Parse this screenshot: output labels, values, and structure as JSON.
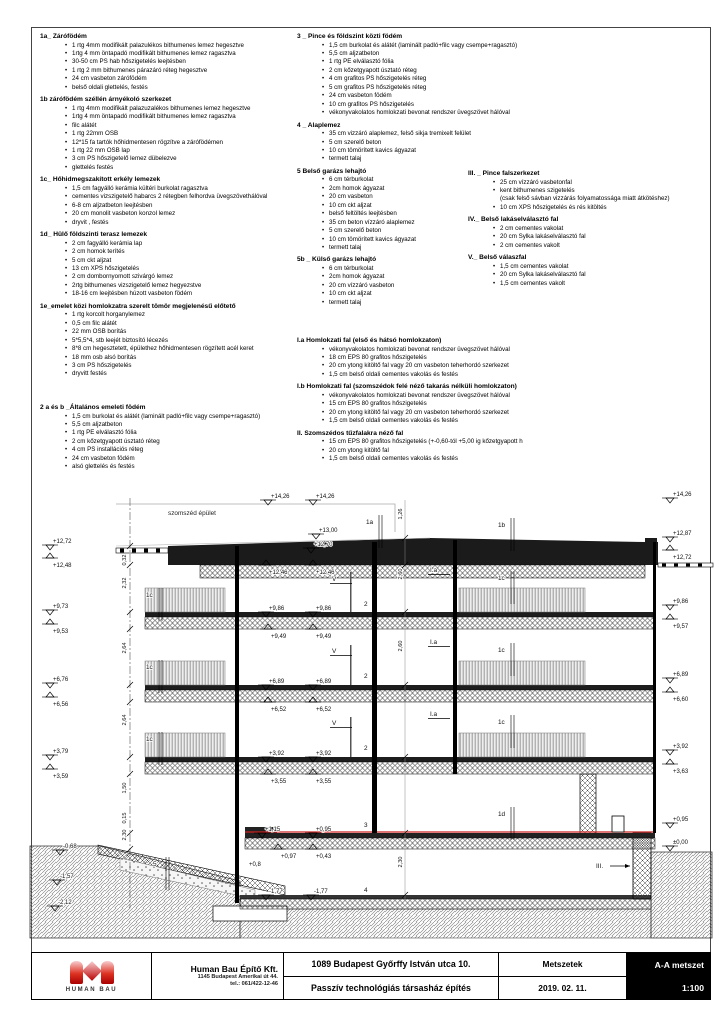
{
  "drawing_meta": {
    "neighbor_label": "szomszéd épület",
    "waterproof_color": "#cc2222"
  },
  "specs": {
    "col1a": [
      {
        "h": "1a_ Zárófödém",
        "items": [
          [
            "•",
            "1 rtg 4mm modifikált palazulékos bithumenes lemez hegesztve"
          ],
          [
            "•",
            "1rtg 4 mm öntapadó modifikált bithumenes lemez ragasztva"
          ],
          [
            "•",
            "30-50 cm PS hab hőszigetelés leejtésben"
          ],
          [
            "•",
            "1 rtg 2 mm bithumenes párazáró réteg hegesztve"
          ],
          [
            "•",
            "24 cm vasbeton zárófödém"
          ],
          [
            "•",
            "belső oldali glettelés, festés"
          ]
        ]
      },
      {
        "h": "1b zárófödém széllén árnyékoló szerkezet",
        "items": [
          [
            "•",
            "1 rtg 4mm modifikált palazuzalékos bithumenes lemez hegesztve"
          ],
          [
            "•",
            "1rtg 4 mm öntapadó modifikált bithumenes lemez ragasztva"
          ],
          [
            "•",
            "filc alátét"
          ],
          [
            "•",
            "1 rtg 22mm OSB"
          ],
          [
            "•",
            "12*15 fa tartók hőhidmentesen rögzítve a zárófödémen"
          ],
          [
            "•",
            "1 rtg 22 mm OSB lap"
          ],
          [
            "•",
            "3 cm PS hőszigetelő lemez dübelezve"
          ],
          [
            "•",
            "glettelés festés"
          ]
        ]
      },
      {
        "h": "1c_ Hőhidmegszakított erkély lemezek",
        "items": [
          [
            "•",
            "1,5 cm fagyálló kerámia kültéri burkolat ragasztva"
          ],
          [
            "•",
            "cementes vizszigetelő habarcs 2 rétegben felhordva üvegszövethálóval"
          ],
          [
            "•",
            "6-8 cm aljzatbeton leejtésben"
          ],
          [
            "•",
            "20 cm monolit vasbeton konzol lemez"
          ],
          [
            "•",
            "dryvit , festés"
          ]
        ]
      },
      {
        "h": "1d_ Hülő földszinti terasz lemezek",
        "items": [
          [
            "•",
            "2 cm fagyálló kerámia lap"
          ],
          [
            "•",
            "2 cm homok terítés"
          ],
          [
            "•",
            "5 cm ckt aljzat"
          ],
          [
            "•",
            "13 cm XPS hőszigetelés"
          ],
          [
            "•",
            "2 cm dombornyomott szivárgó lemez"
          ],
          [
            "•",
            "2rtg bithumenes vizszigetelő lemez hegyezstve"
          ],
          [
            "•",
            "18-16 cm leejtésben húzott vasbeton födém"
          ]
        ]
      },
      {
        "h": "1e_emelet közi homlokzatra szerelt tömör megjelenésű előtető",
        "items": [
          [
            "•",
            "1 rtg korcolt horganylemez"
          ],
          [
            "•",
            "0,5 cm filc alátét"
          ],
          [
            "•",
            "22 mm OSB borítás"
          ],
          [
            "•",
            "5*5,5*4, stb leejét biztosító lécezés"
          ],
          [
            "•",
            "8*8 cm hegesztetett, épülethez hőhidmentesen rögzített acél keret"
          ],
          [
            "•",
            "18 mm osb alsó borítás"
          ],
          [
            "•",
            "3 cm PS hőszigetelés"
          ],
          [
            "•",
            "dryvitt festés"
          ]
        ]
      }
    ],
    "col1b": [
      {
        "h": "2 a és b _Általános emeleti födém",
        "items": [
          [
            "•",
            "1,5 cm burkolat és alátét (laminált padló+filc vagy csempe+ragasztó)"
          ],
          [
            "•",
            "5,5 cm aljzatbeton"
          ],
          [
            "•",
            "1 rtg PE elválasztó fólia"
          ],
          [
            "•",
            "2 cm kőzetgyapott úsztató réteg"
          ],
          [
            "•",
            "4 cm PS installációs réteg"
          ],
          [
            "•",
            "24 cm vasbeton födém"
          ],
          [
            "•",
            "alsó glettelés és festés"
          ]
        ]
      }
    ],
    "col2a": [
      {
        "h": "3 _ Pince és földszint közti födém",
        "items": [
          [
            "•",
            "1,5 cm burkolat és alátét (laminált padló+filc vagy csempe+ragasztó)"
          ],
          [
            "•",
            "5,5 cm aljzatbeton"
          ],
          [
            "•",
            "1 rtg PE elválasztó fólia"
          ],
          [
            "•",
            "2 cm kőzetgyapott úsztató réteg"
          ],
          [
            "•",
            "4 cm grafitos PS hőszigetelés réteg"
          ],
          [
            "•",
            "5 cm grafitos PS hőszigetelés réteg"
          ],
          [
            "•",
            "24 cm vasbeton födém"
          ],
          [
            "•",
            "10 cm grafitos PS hőszigetelés"
          ],
          [
            "•",
            "vékonyvakolatos homlokzati bevonat rendszer üvegszövet hálóval"
          ]
        ]
      },
      {
        "h": "4 _ Alaplemez",
        "items": [
          [
            "•",
            "35 cm vizzáró alaplemez, felső sikja tremixelt felület"
          ],
          [
            "•",
            "5 cm szerelő beton"
          ],
          [
            "•",
            "10 cm tömörített kavics ágyazat"
          ],
          [
            "•",
            "termett talaj"
          ]
        ]
      },
      {
        "h": "5 Belső garázs lehajtó",
        "items": [
          [
            "•",
            "6 cm térburkolat"
          ],
          [
            "•",
            "2cm homok ágyazat"
          ],
          [
            "•",
            "20 cm vasbeton"
          ],
          [
            "•",
            "10 cm ckt aljzat"
          ],
          [
            "•",
            "belső feltöltés leejtésben"
          ],
          [
            "•",
            "35 cm beton vízzáró alaplemez"
          ],
          [
            "•",
            "5 cm szerelő beton"
          ],
          [
            "•",
            "10 cm tömörített kavics ágyazat"
          ],
          [
            "•",
            "termett talaj"
          ]
        ]
      },
      {
        "h": "5b _ Külső garázs lehajtó",
        "items": [
          [
            "•",
            "6 cm térburkolat"
          ],
          [
            "•",
            "2cm homok ágyazat"
          ],
          [
            "•",
            "20 cm vízzáró vasbeton"
          ],
          [
            "•",
            "10 cm ckt aljzat"
          ],
          [
            "•",
            "termett talaj"
          ]
        ]
      }
    ],
    "col2b": [
      {
        "h": "I.a Homlokzati fal (első és hátsó homlokzaton)",
        "items": [
          [
            "•",
            "vékonyvakolatos homlokzati bevonat rendszer üvegszövet hálóval"
          ],
          [
            "•",
            "18 cm EPS 80 grafitos hőszigetelés"
          ],
          [
            "•",
            "20 cm ytong kitöltő fal vagy 20 cm vasbeton teherhordó szerkezet"
          ],
          [
            "•",
            "1,5 cm belső oldali cementes vakolás és festés"
          ]
        ]
      },
      {
        "h": "I.b Homlokzati fal (szomszédok felé néző takarás nélküli homlokzaton)",
        "items": [
          [
            "•",
            "vékonyvakolatos homlokzati bevonat rendszer üvegszövet hálóval"
          ],
          [
            "•",
            "15 cm EPS 80 grafitos hőszigetelés"
          ],
          [
            "•",
            "20 cm ytong kitöltő fal vagy 20 cm vasbeton teherhordó szerkezet"
          ],
          [
            "•",
            "1,5 cm belső oldali cementes vakolás és festés"
          ]
        ]
      },
      {
        "h": "II. Szomszédos tűzfalakra néző fal",
        "items": [
          [
            "•",
            "15 cm EPS 80 grafitos hőszigetelés (+-0,60-tól +5,00 ig kőzetgyapott h"
          ],
          [
            "•",
            "20 cm ytong kitöltő fal"
          ],
          [
            "•",
            "1,5 cm belső oldali cementes vakolás és festés"
          ]
        ]
      }
    ],
    "col3": [
      {
        "h": "III. _ Pince falszerkezet",
        "items": [
          [
            "•",
            "25 cm vízzáró vasbetonfal"
          ],
          [
            "•",
            "kent bithumenes szigetelés"
          ],
          [
            "",
            "(csak felső sávban vizzárás folyamatossága miatt átkötéshez)"
          ],
          [
            "•",
            "10 cm XPS hőszigetelés és rés kitöltés"
          ]
        ]
      },
      {
        "h": "IV._ Belső lakáselválasztó fal",
        "items": [
          [
            "•",
            "2 cm cementes vakolat"
          ],
          [
            "•",
            "20 cm Sylka lakáselválasztó fal"
          ],
          [
            "•",
            "2 cm cementes vakolt"
          ]
        ]
      },
      {
        "h": "V._ Belső válaszfal",
        "items": [
          [
            "•",
            "1,5 cm cementes vakolat"
          ],
          [
            "•",
            "20 cm Sylka lakáselválasztó fal"
          ],
          [
            "•",
            "1,5 cm cementes vakolt"
          ]
        ]
      }
    ]
  },
  "drawing": {
    "neighbor_label": "szomszéd épület",
    "markers": [
      {
        "t": "+12,72",
        "x": 50,
        "y": 57,
        "v": "dn"
      },
      {
        "t": "+12,48",
        "x": 50,
        "y": 70,
        "v": "up"
      },
      {
        "t": "+9,73",
        "x": 50,
        "y": 122,
        "v": "dn"
      },
      {
        "t": "+9,53",
        "x": 50,
        "y": 136,
        "v": "up"
      },
      {
        "t": "+6,76",
        "x": 50,
        "y": 195,
        "v": "dn"
      },
      {
        "t": "+6,56",
        "x": 50,
        "y": 209,
        "v": "up"
      },
      {
        "t": "+3,79",
        "x": 50,
        "y": 267,
        "v": "dn"
      },
      {
        "t": "+3,59",
        "x": 50,
        "y": 281,
        "v": "up"
      },
      {
        "t": "+14,26",
        "x": 268,
        "y": 12,
        "v": "dn"
      },
      {
        "t": "+14,26",
        "x": 313,
        "y": 12,
        "v": "dn"
      },
      {
        "t": "+13,00",
        "x": 316,
        "y": 46,
        "v": "dn"
      },
      {
        "t": "+14,26",
        "x": 670,
        "y": 10,
        "v": "dn"
      },
      {
        "t": "+12,87",
        "x": 670,
        "y": 49,
        "v": "dn"
      },
      {
        "t": "+12,72",
        "x": 670,
        "y": 62,
        "v": "up"
      },
      {
        "t": "+9,86",
        "x": 670,
        "y": 117,
        "v": "dn"
      },
      {
        "t": "+9,57",
        "x": 670,
        "y": 131,
        "v": "up"
      },
      {
        "t": "+6,89",
        "x": 670,
        "y": 190,
        "v": "dn"
      },
      {
        "t": "+6,60",
        "x": 670,
        "y": 204,
        "v": "up"
      },
      {
        "t": "+3,92",
        "x": 670,
        "y": 262,
        "v": "dn"
      },
      {
        "t": "+3,63",
        "x": 670,
        "y": 276,
        "v": "up"
      },
      {
        "t": "+0,95",
        "x": 670,
        "y": 335,
        "v": "dn"
      },
      {
        "t": "±0,00",
        "x": 670,
        "y": 358,
        "v": "dn"
      },
      {
        "t": "+12,70",
        "x": 311,
        "y": 60,
        "v": "dn"
      },
      {
        "t": "+12,46",
        "x": 266,
        "y": 77,
        "v": "up"
      },
      {
        "t": "+12,46",
        "x": 313,
        "y": 77,
        "v": "up"
      },
      {
        "t": "+9,86",
        "x": 266,
        "y": 124,
        "v": "dn"
      },
      {
        "t": "+9,86",
        "x": 313,
        "y": 124,
        "v": "dn"
      },
      {
        "t": "+9,49",
        "x": 268,
        "y": 141,
        "v": "up"
      },
      {
        "t": "+9,49",
        "x": 313,
        "y": 141,
        "v": "up"
      },
      {
        "t": "+6,89",
        "x": 266,
        "y": 197,
        "v": "dn"
      },
      {
        "t": "+6,89",
        "x": 313,
        "y": 197,
        "v": "dn"
      },
      {
        "t": "+6,52",
        "x": 268,
        "y": 214,
        "v": "up"
      },
      {
        "t": "+6,52",
        "x": 313,
        "y": 214,
        "v": "up"
      },
      {
        "t": "+3,92",
        "x": 266,
        "y": 269,
        "v": "dn"
      },
      {
        "t": "+3,92",
        "x": 313,
        "y": 269,
        "v": "dn"
      },
      {
        "t": "+3,55",
        "x": 268,
        "y": 286,
        "v": "up"
      },
      {
        "t": "+3,55",
        "x": 313,
        "y": 286,
        "v": "up"
      },
      {
        "t": "+1,15",
        "x": 262,
        "y": 345,
        "v": "dn"
      },
      {
        "t": "+0,95",
        "x": 313,
        "y": 345,
        "v": "dn"
      },
      {
        "t": "+0,97",
        "x": 278,
        "y": 361,
        "v": "up"
      },
      {
        "t": "+0,43",
        "x": 313,
        "y": 361,
        "v": "up"
      },
      {
        "t": "+0,8",
        "x": 246,
        "y": 378,
        "v": "tx"
      },
      {
        "t": "-1,77",
        "x": 266,
        "y": 407,
        "v": "dn"
      },
      {
        "t": "-1,77",
        "x": 311,
        "y": 407,
        "v": "dn"
      },
      {
        "t": "-0,68",
        "x": 60,
        "y": 362,
        "v": "dn"
      },
      {
        "t": "-1,57",
        "x": 57,
        "y": 392,
        "v": "dn"
      },
      {
        "t": "-2,12",
        "x": 55,
        "y": 418,
        "v": "dn"
      }
    ],
    "labels": [
      {
        "t": "1a",
        "x": 366,
        "y": 36,
        "ld": "v"
      },
      {
        "t": "1b",
        "x": 498,
        "y": 39,
        "ld": "v"
      },
      {
        "t": "1c",
        "x": 146,
        "y": 109,
        "ld": "v"
      },
      {
        "t": "1c",
        "x": 146,
        "y": 181,
        "ld": "v"
      },
      {
        "t": "1c",
        "x": 146,
        "y": 253,
        "ld": "v"
      },
      {
        "t": "1c",
        "x": 498,
        "y": 92,
        "ld": "v"
      },
      {
        "t": "1c",
        "x": 498,
        "y": 164,
        "ld": "v"
      },
      {
        "t": "1c",
        "x": 498,
        "y": 236,
        "ld": "v"
      },
      {
        "t": "1d",
        "x": 498,
        "y": 328,
        "ld": "v"
      },
      {
        "t": "2",
        "x": 364,
        "y": 118,
        "ld": ""
      },
      {
        "t": "2",
        "x": 364,
        "y": 190,
        "ld": ""
      },
      {
        "t": "2",
        "x": 364,
        "y": 262,
        "ld": ""
      },
      {
        "t": "3",
        "x": 364,
        "y": 339,
        "ld": ""
      },
      {
        "t": "4",
        "x": 364,
        "y": 404,
        "ld": ""
      },
      {
        "t": "5",
        "x": 153,
        "y": 378,
        "ld": "v"
      },
      {
        "t": "I.a",
        "x": 430,
        "y": 84,
        "ld": "h"
      },
      {
        "t": "I.a",
        "x": 430,
        "y": 156,
        "ld": "h"
      },
      {
        "t": "I.a",
        "x": 430,
        "y": 228,
        "ld": "h"
      },
      {
        "t": "V",
        "x": 332,
        "y": 93,
        "ld": "h"
      },
      {
        "t": "V",
        "x": 332,
        "y": 165,
        "ld": "h"
      },
      {
        "t": "V",
        "x": 332,
        "y": 237,
        "ld": "h"
      },
      {
        "t": "III.",
        "x": 596,
        "y": 380,
        "ld": "a"
      }
    ],
    "dims": [
      {
        "t": "0,32",
        "x": 126,
        "y": 72
      },
      {
        "t": "2,32",
        "x": 126,
        "y": 95
      },
      {
        "t": "2,64",
        "x": 126,
        "y": 160
      },
      {
        "t": "2,64",
        "x": 126,
        "y": 232
      },
      {
        "t": "1,50",
        "x": 126,
        "y": 300
      },
      {
        "t": "0,15",
        "x": 126,
        "y": 330
      },
      {
        "t": "2,30",
        "x": 126,
        "y": 347
      },
      {
        "t": "1,26",
        "x": 402,
        "y": 26
      },
      {
        "t": "2,60",
        "x": 402,
        "y": 86
      },
      {
        "t": "2,60",
        "x": 402,
        "y": 158
      },
      {
        "t": "2,30",
        "x": 402,
        "y": 374
      }
    ]
  },
  "titleblock": {
    "logo_text": "HUMAN BAU",
    "company_name": "Human Bau Építő Kft.",
    "company_addr1": "1145 Budapest Amerikai út 44.",
    "company_addr2": "tel.: 061/422-12-46",
    "project_addr": "1089 Budapest Győrffy István utca 10.",
    "project_name": "Passzív technológiás társasház építés",
    "sheet_type": "Metszetek",
    "date": "2019. 02. 11.",
    "sheet_name": "A-A metszet",
    "scale": "1:100"
  }
}
